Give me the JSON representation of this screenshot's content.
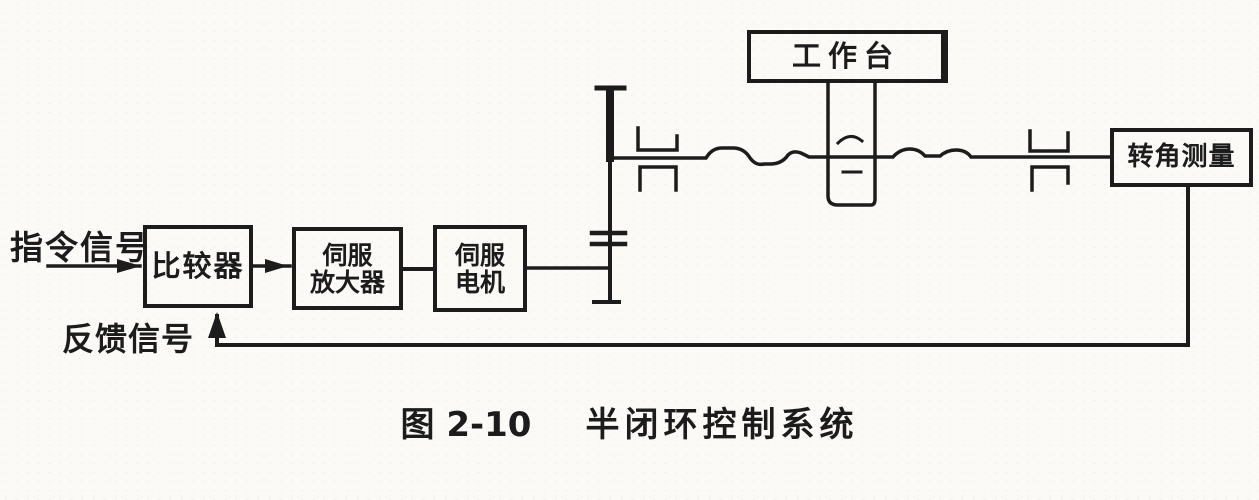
{
  "labels": {
    "command_signal": "指令信号",
    "feedback_signal": "反馈信号"
  },
  "blocks": {
    "comparator": "比较器",
    "servo_amplifier": {
      "line1": "伺服",
      "line2": "放大器"
    },
    "servo_motor": {
      "line1": "伺服",
      "line2": "电机"
    },
    "worktable": "工作台",
    "angle_measurement": "转角测量"
  },
  "caption": {
    "figure_number": "图 2-10",
    "title": "半闭环控制系统"
  },
  "colors": {
    "ink": "#1c1c1c",
    "paper": "#fbfaf7"
  }
}
